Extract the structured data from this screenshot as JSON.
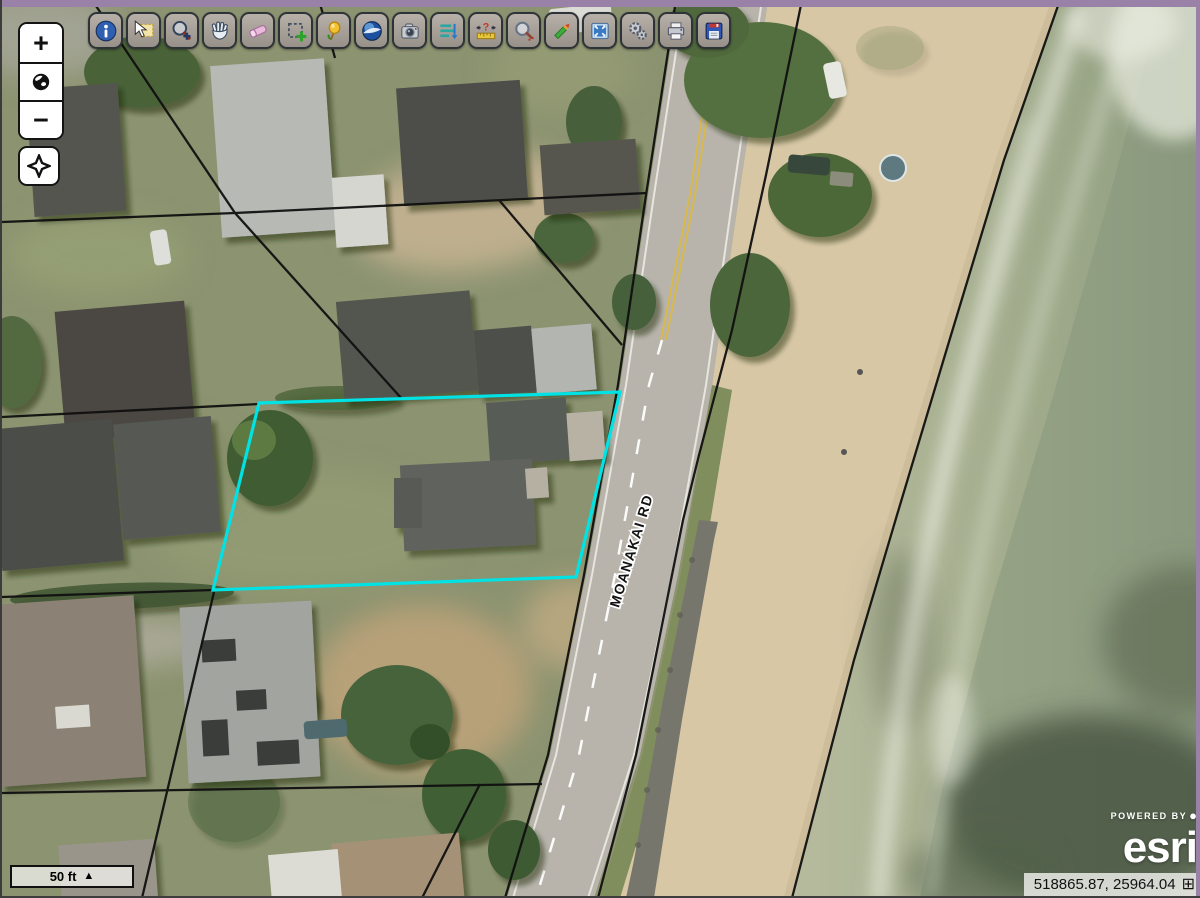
{
  "window": {
    "top_bar_color": "#9a81a7",
    "border_color": "#3c3c3c"
  },
  "toolbar": {
    "buttons": [
      "info-icon",
      "select-features-icon",
      "zoom-in-icon",
      "pan-icon",
      "eraser-icon",
      "select-rectangle-icon",
      "pushpin-icon",
      "globe-3d-icon",
      "photo-icon",
      "legend-list-icon",
      "measure-icon",
      "magnifier-icon",
      "pencil-draw-icon",
      "zoom-extent-icon",
      "gears-icon",
      "print-icon",
      "save-icon"
    ]
  },
  "zoom_controls": {
    "zoom_in_label": "+",
    "zoom_out_label": "−",
    "icons": [
      "plus-icon",
      "globe-icon",
      "minus-icon",
      "locate-crosshair-icon"
    ]
  },
  "map": {
    "road_label": "MOANAKAI RD",
    "parcel_outline_color": "#00e2e4",
    "cadastral_line_color": "#101010"
  },
  "scale_bar": {
    "text": "50 ft",
    "arrow": "▲"
  },
  "status_bar": {
    "coordinates": "518865.87, 25964.04",
    "expand_icon": "⊞"
  },
  "attribution": {
    "powered_by": "POWERED BY",
    "logo_dot": "●",
    "brand": "esri"
  }
}
